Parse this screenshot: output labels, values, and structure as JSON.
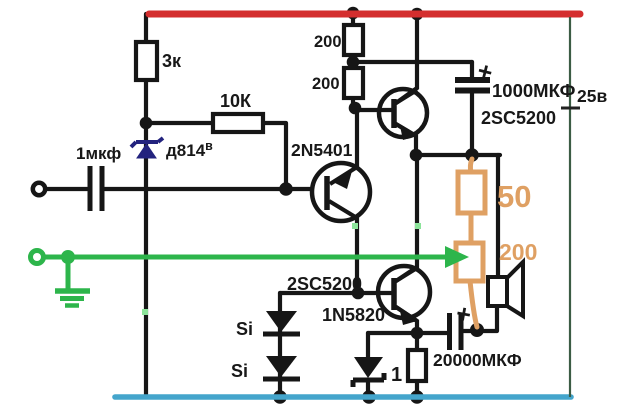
{
  "diagram": {
    "kind": "transistor audio amplifier schematic",
    "colors": {
      "positive_rail": "#d larger42e2e",
      "ground_rail": "#44a5cc",
      "signal_line": "#2db54b",
      "highlight": "#dfa063",
      "zener_symbol": "#23237e"
    },
    "labels": {
      "r3k": "3к",
      "r10k": "10К",
      "cin": "1мкф",
      "zener": "д814",
      "zener_sup": "в",
      "q1": "2N5401",
      "r200a": "200",
      "r200b": "200",
      "cboot": "1000МКФ",
      "q2": "2SC5200",
      "battery": "25в",
      "r50": "50",
      "r200o": "200",
      "q3": "2SC5200",
      "d_schottky": "1N5820",
      "si1": "Si",
      "si2": "Si",
      "r1ohm": "1",
      "cout": "20000МКФ",
      "plus_boot": "+",
      "plus_out": "+"
    }
  }
}
